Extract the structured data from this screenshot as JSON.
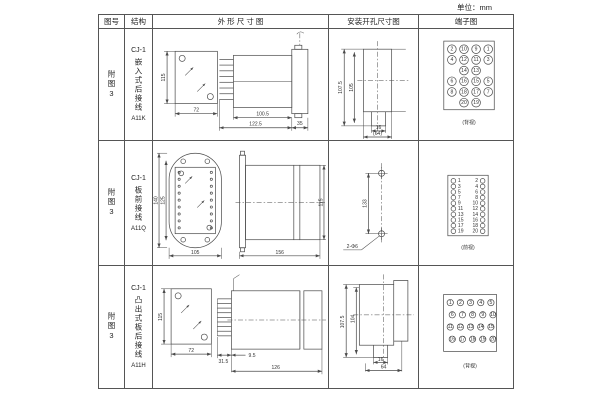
{
  "unit_label": "单位：mm",
  "headers": {
    "figure": "图号",
    "structure": "结构",
    "outline": "外 形 尺 寸 图",
    "mounting": "安装开孔尺寸图",
    "terminal": "端子图"
  },
  "rows": [
    {
      "figure_no": "附图3",
      "series": "CJ-1",
      "structure": "嵌入式后接线",
      "model": "A11K",
      "outline": {
        "height": "115",
        "width": "72",
        "body_length": "100.5",
        "total_length": "122.5",
        "flange_length": "35"
      },
      "mounting": {
        "outer_height": "107.5",
        "inner_height": "105",
        "notch_width": "16",
        "span": "(64)"
      },
      "terminal": {
        "view": "(背视)",
        "rows": [
          [
            2,
            10,
            9,
            1
          ],
          [
            4,
            12,
            11,
            3
          ],
          [
            14,
            13
          ],
          [
            6,
            16,
            15,
            5
          ],
          [
            8,
            18,
            17,
            7
          ],
          [
            20,
            19
          ]
        ]
      }
    },
    {
      "figure_no": "附图3",
      "series": "CJ-1",
      "structure": "板前接线",
      "model": "A11Q",
      "outline": {
        "outer_height": "140",
        "inner_height": "125",
        "width": "105",
        "depth": "156",
        "side_height": "115"
      },
      "mounting": {
        "hole_spacing": "133",
        "hole_label": "2-Φ6"
      },
      "terminal": {
        "view": "(前视)",
        "left": [
          1,
          3,
          5,
          7,
          9,
          11,
          13,
          15,
          17,
          19
        ],
        "right": [
          2,
          4,
          6,
          8,
          10,
          12,
          14,
          16,
          18,
          20
        ]
      }
    },
    {
      "figure_no": "附图3",
      "series": "CJ-1",
      "structure": "凸出式板后接线",
      "model": "A11H",
      "outline": {
        "height": "115",
        "width": "72",
        "pin_length": "31.5",
        "offset": "9.5",
        "depth": "126"
      },
      "mounting": {
        "outer_height": "107.5",
        "inner_height": "104",
        "notch_width": "16",
        "span": "64"
      },
      "terminal": {
        "view": "(背视)",
        "rows": [
          [
            1,
            2,
            3,
            4,
            5
          ],
          [
            6,
            7,
            8,
            9,
            10
          ],
          [
            11,
            12,
            13,
            14,
            15
          ],
          [
            16,
            17,
            18,
            19,
            20
          ]
        ]
      }
    }
  ]
}
